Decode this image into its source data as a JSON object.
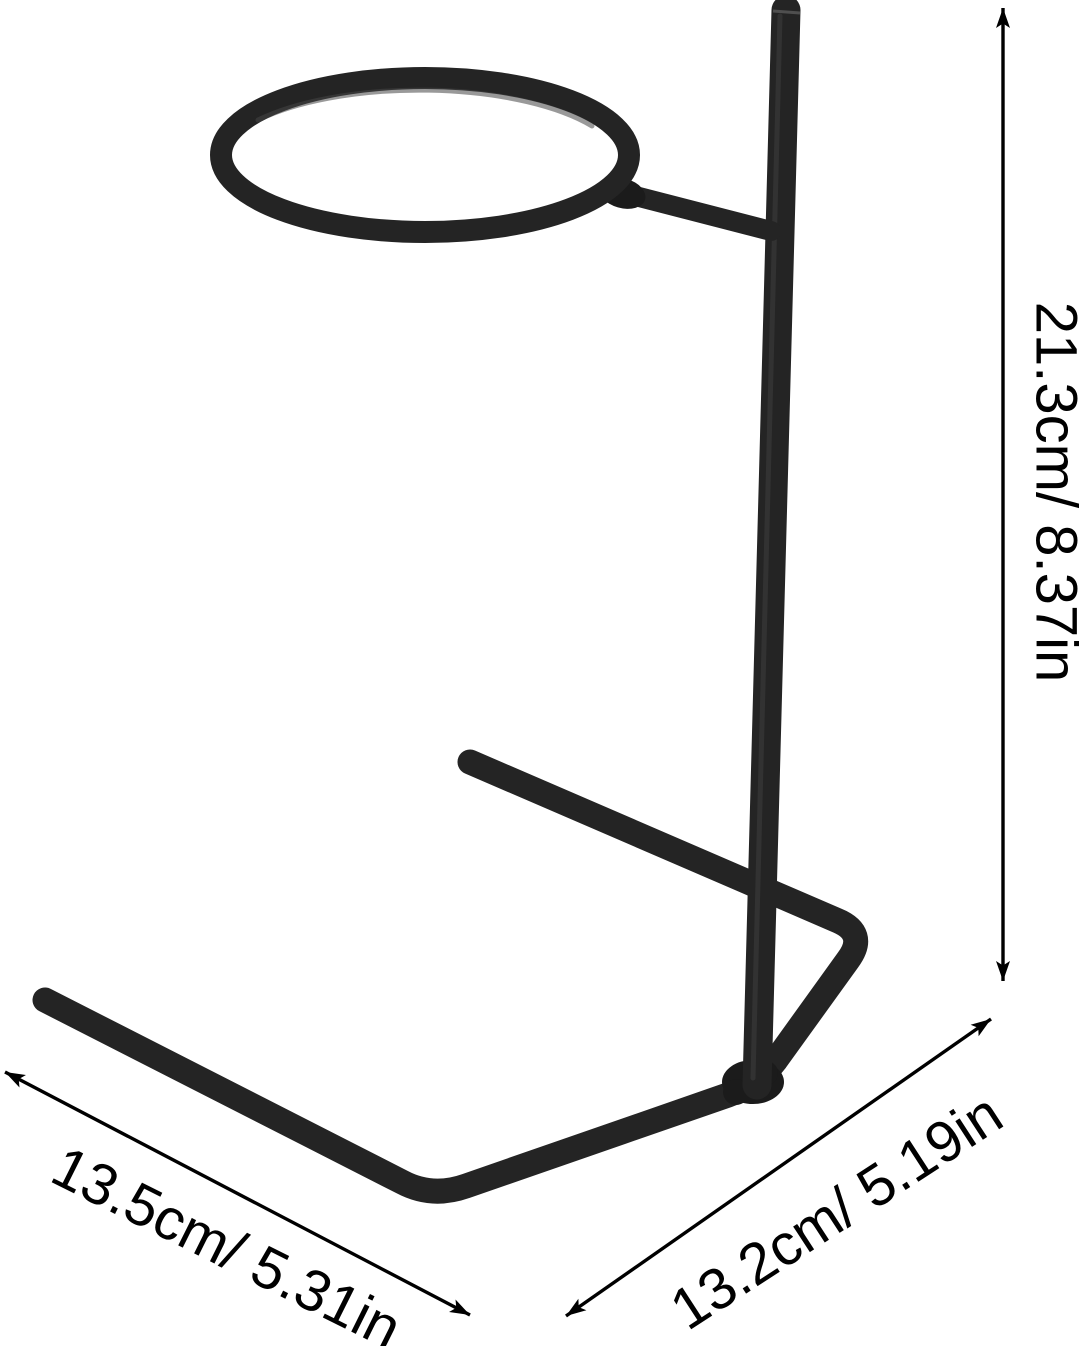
{
  "image": {
    "subject": "black metal stand with round ring holder on bent-wire base",
    "background_color": "#ffffff",
    "wire_color": "#242424",
    "dimension_color": "#000000"
  },
  "dimension_labels": {
    "height": "21.3cm/ 8.37in",
    "base_left_edge": "13.5cm/ 5.31in",
    "base_right_edge": "13.2cm/ 5.19in"
  }
}
